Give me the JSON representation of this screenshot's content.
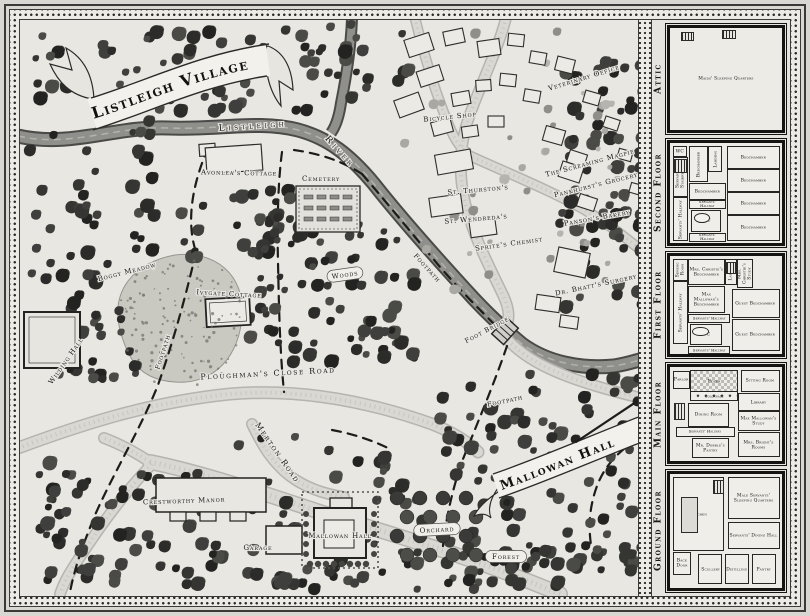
{
  "palette": {
    "paper": "#e9e7e2",
    "ink": "#1a1a18",
    "river": "#8f8f8b",
    "road": "#d9d8d2",
    "tree_dark": "#2f2f2d",
    "border_band": "#eceae5"
  },
  "map": {
    "title_banner": "Listleigh Village",
    "hall_banner": "Mallowan Hall",
    "labels": [
      {
        "id": "river-name-1",
        "text": "Listleigh",
        "x": 253,
        "y": 126,
        "rot": -4,
        "size": 9,
        "spacing": 3.5
      },
      {
        "id": "river-name-2",
        "text": "River",
        "x": 340,
        "y": 152,
        "rot": 48,
        "size": 9,
        "spacing": 3.5
      },
      {
        "id": "avonleas-cottage",
        "text": "Avonlea's Cottage",
        "x": 239,
        "y": 173,
        "rot": 1,
        "size": 7
      },
      {
        "id": "cemetery",
        "text": "Cemetery",
        "x": 321,
        "y": 179,
        "rot": 0,
        "size": 7
      },
      {
        "id": "veterinary-office",
        "text": "Veterinary Office",
        "x": 584,
        "y": 78,
        "rot": -17,
        "size": 7
      },
      {
        "id": "bicycle-shop",
        "text": "Bicycle Shop",
        "x": 450,
        "y": 117,
        "rot": -6,
        "size": 7
      },
      {
        "id": "the-screaming-magpie",
        "text": "The Screaming Magpie",
        "x": 590,
        "y": 163,
        "rot": -15,
        "size": 7
      },
      {
        "id": "st-thurstons",
        "text": "St. Thurston's",
        "x": 478,
        "y": 190,
        "rot": -5,
        "size": 7
      },
      {
        "id": "pankhursts-grocery",
        "text": "Pankhurst's Grocery",
        "x": 596,
        "y": 185,
        "rot": -14,
        "size": 7
      },
      {
        "id": "pansons-bakery",
        "text": "Panson's Bakery",
        "x": 597,
        "y": 218,
        "rot": -10,
        "size": 7
      },
      {
        "id": "st-wendredas",
        "text": "St. Wendreda's",
        "x": 476,
        "y": 219,
        "rot": -5,
        "size": 7
      },
      {
        "id": "sprites-chemist",
        "text": "Sprite's Chemist",
        "x": 509,
        "y": 244,
        "rot": -8,
        "size": 7
      },
      {
        "id": "dr-bhatts-surgery",
        "text": "Dr. Bhatt's Surgery",
        "x": 596,
        "y": 285,
        "rot": -12,
        "size": 7
      },
      {
        "id": "boggy-meadow",
        "text": "Boggy Meadow",
        "x": 127,
        "y": 272,
        "rot": -14,
        "size": 7
      },
      {
        "id": "ivygate-cottage",
        "text": "Ivygate Cottage",
        "x": 229,
        "y": 294,
        "rot": 3,
        "size": 7
      },
      {
        "id": "wilding-hall",
        "text": "Wilding Hall",
        "x": 66,
        "y": 361,
        "rot": -55,
        "size": 7
      },
      {
        "id": "footpath-west",
        "text": "Footpath",
        "x": 163,
        "y": 352,
        "rot": -72,
        "size": 6.5
      },
      {
        "id": "woods",
        "text": "Woods",
        "x": 345,
        "y": 275,
        "rot": -8,
        "size": 7,
        "loz": true
      },
      {
        "id": "footpath-river",
        "text": "Footpath",
        "x": 427,
        "y": 268,
        "rot": 48,
        "size": 6.5
      },
      {
        "id": "foot-bridge",
        "text": "Foot Bridge",
        "x": 487,
        "y": 330,
        "rot": -28,
        "size": 6.5
      },
      {
        "id": "ploughmans-close-road",
        "text": "Ploughman's Close Road",
        "x": 268,
        "y": 374,
        "rot": -3,
        "size": 8,
        "spacing": 1.6
      },
      {
        "id": "footpath-south",
        "text": "Footpath",
        "x": 505,
        "y": 401,
        "rot": -12,
        "size": 6.5
      },
      {
        "id": "merton-road",
        "text": "Merton Road",
        "x": 277,
        "y": 453,
        "rot": 55,
        "size": 8,
        "spacing": 1.6
      },
      {
        "id": "crestworthy-manor",
        "text": "Crestworthy Manor",
        "x": 184,
        "y": 501,
        "rot": -2,
        "size": 7
      },
      {
        "id": "garage",
        "text": "Garage",
        "x": 258,
        "y": 548,
        "rot": 0,
        "size": 7
      },
      {
        "id": "mallowan-hall-house",
        "text": "Mallowan Hall",
        "x": 340,
        "y": 536,
        "rot": 0,
        "size": 7
      },
      {
        "id": "orchard",
        "text": "Orchard",
        "x": 437,
        "y": 530,
        "rot": -3,
        "size": 7,
        "loz": true
      },
      {
        "id": "forest",
        "text": "Forest",
        "x": 506,
        "y": 557,
        "rot": 0,
        "size": 7,
        "loz": true
      }
    ]
  },
  "sidebar": {
    "floors": [
      {
        "id": "attic",
        "name": "Attic",
        "rooms": [
          {
            "label": "Maids' Sleeping Quarters",
            "x": 22,
            "y": 34,
            "w": 56,
            "h": 32,
            "open": true
          }
        ]
      },
      {
        "id": "second-floor",
        "name": "Second Floor",
        "rooms": [
          {
            "label": "WC",
            "x": 3,
            "y": 3,
            "w": 10,
            "h": 9
          },
          {
            "label": "Servants' Stairwell",
            "x": 3,
            "y": 14,
            "w": 11,
            "h": 38,
            "vert": true
          },
          {
            "label": "Servants' Hallway",
            "x": 3,
            "y": 54,
            "w": 11,
            "h": 42,
            "vert": true
          },
          {
            "label": "Bedchamber",
            "x": 17,
            "y": 3,
            "w": 15,
            "h": 34,
            "vert": true
          },
          {
            "label": "Landing",
            "x": 34,
            "y": 3,
            "w": 11,
            "h": 24,
            "vert": true
          },
          {
            "label": "Bedchamber",
            "x": 17,
            "y": 40,
            "w": 31,
            "h": 15
          },
          {
            "label": "Servants' Hallway",
            "x": 17,
            "y": 57,
            "w": 31,
            "h": 7,
            "thin": true
          },
          {
            "label": "WC",
            "x": 19,
            "y": 67,
            "w": 25,
            "h": 20
          },
          {
            "label": "Servants' Hallway",
            "x": 17,
            "y": 90,
            "w": 31,
            "h": 7,
            "thin": true
          },
          {
            "label": "Bedchamber",
            "x": 51,
            "y": 3,
            "w": 45,
            "h": 21
          },
          {
            "label": "Bedchamber",
            "x": 51,
            "y": 26,
            "w": 45,
            "h": 21
          },
          {
            "label": "Bedchamber",
            "x": 51,
            "y": 49,
            "w": 45,
            "h": 21
          },
          {
            "label": "Bedchamber",
            "x": 51,
            "y": 72,
            "w": 45,
            "h": 24
          }
        ]
      },
      {
        "id": "first-floor",
        "name": "First Floor",
        "rooms": [
          {
            "label": "Sewing Room",
            "x": 3,
            "y": 3,
            "w": 11,
            "h": 20,
            "vert": true
          },
          {
            "label": "Servants' Hallway",
            "x": 3,
            "y": 26,
            "w": 11,
            "h": 62,
            "vert": true
          },
          {
            "label": "Mrs. Christie's Bedchamber",
            "x": 16,
            "y": 3,
            "w": 31,
            "h": 25
          },
          {
            "label": "Landing",
            "x": 49,
            "y": 3,
            "w": 9,
            "h": 25,
            "vert": true
          },
          {
            "label": "Mrs. Christie's Study",
            "x": 60,
            "y": 3,
            "w": 12,
            "h": 28,
            "vert": true
          },
          {
            "label": "Max Mallowan's Bedchamber",
            "x": 16,
            "y": 31,
            "w": 31,
            "h": 25
          },
          {
            "label": "Guest Bedchamber",
            "x": 55,
            "y": 34,
            "w": 41,
            "h": 27
          },
          {
            "label": "Guest Bedchamber",
            "x": 55,
            "y": 64,
            "w": 41,
            "h": 31
          },
          {
            "label": "Servants' Hallway",
            "x": 16,
            "y": 59,
            "w": 36,
            "h": 7,
            "thin": true
          },
          {
            "label": "WC",
            "x": 18,
            "y": 69,
            "w": 27,
            "h": 20
          },
          {
            "label": "Servants' Hallway",
            "x": 16,
            "y": 92,
            "w": 36,
            "h": 6,
            "thin": true
          }
        ]
      },
      {
        "id": "main-floor",
        "name": "Main Floor",
        "rooms": [
          {
            "label": "Parlor",
            "x": 3,
            "y": 4,
            "w": 13,
            "h": 17
          },
          {
            "label": "Foyer",
            "x": 18,
            "y": 3,
            "w": 41,
            "h": 23,
            "checker": true
          },
          {
            "label": "Colonnade",
            "x": 18,
            "y": 26,
            "w": 41,
            "h": 8,
            "thin": true,
            "cols": true
          },
          {
            "label": "Sitting Room",
            "x": 63,
            "y": 3,
            "w": 33,
            "h": 21
          },
          {
            "label": "Dining Room",
            "x": 16,
            "y": 38,
            "w": 35,
            "h": 24
          },
          {
            "label": "Library",
            "x": 61,
            "y": 28,
            "w": 35,
            "h": 17
          },
          {
            "label": "Max Mallowan's Study",
            "x": 61,
            "y": 47,
            "w": 35,
            "h": 19
          },
          {
            "label": "Servants' Hallway",
            "x": 5,
            "y": 64,
            "w": 51,
            "h": 8,
            "thin": true
          },
          {
            "label": "Mr. Dobble's Pantry",
            "x": 20,
            "y": 75,
            "w": 31,
            "h": 20
          },
          {
            "label": "Mrs. Bright's Rooms",
            "x": 61,
            "y": 69,
            "w": 35,
            "h": 25
          }
        ]
      },
      {
        "id": "ground-floor",
        "name": "Ground Floor",
        "rooms": [
          {
            "label": "Kitchen",
            "x": 3,
            "y": 3,
            "w": 43,
            "h": 63
          },
          {
            "label": "Male Servants' Sleeping Quarters",
            "x": 52,
            "y": 3,
            "w": 44,
            "h": 35
          },
          {
            "label": "Servants' Dining Hall",
            "x": 52,
            "y": 42,
            "w": 44,
            "h": 22
          },
          {
            "label": "Back Door",
            "x": 3,
            "y": 68,
            "w": 14,
            "h": 19
          },
          {
            "label": "Scullery",
            "x": 25,
            "y": 70,
            "w": 20,
            "h": 25
          },
          {
            "label": "Distilling",
            "x": 49,
            "y": 70,
            "w": 20,
            "h": 25
          },
          {
            "label": "Pantry",
            "x": 73,
            "y": 70,
            "w": 20,
            "h": 25
          }
        ]
      }
    ]
  }
}
